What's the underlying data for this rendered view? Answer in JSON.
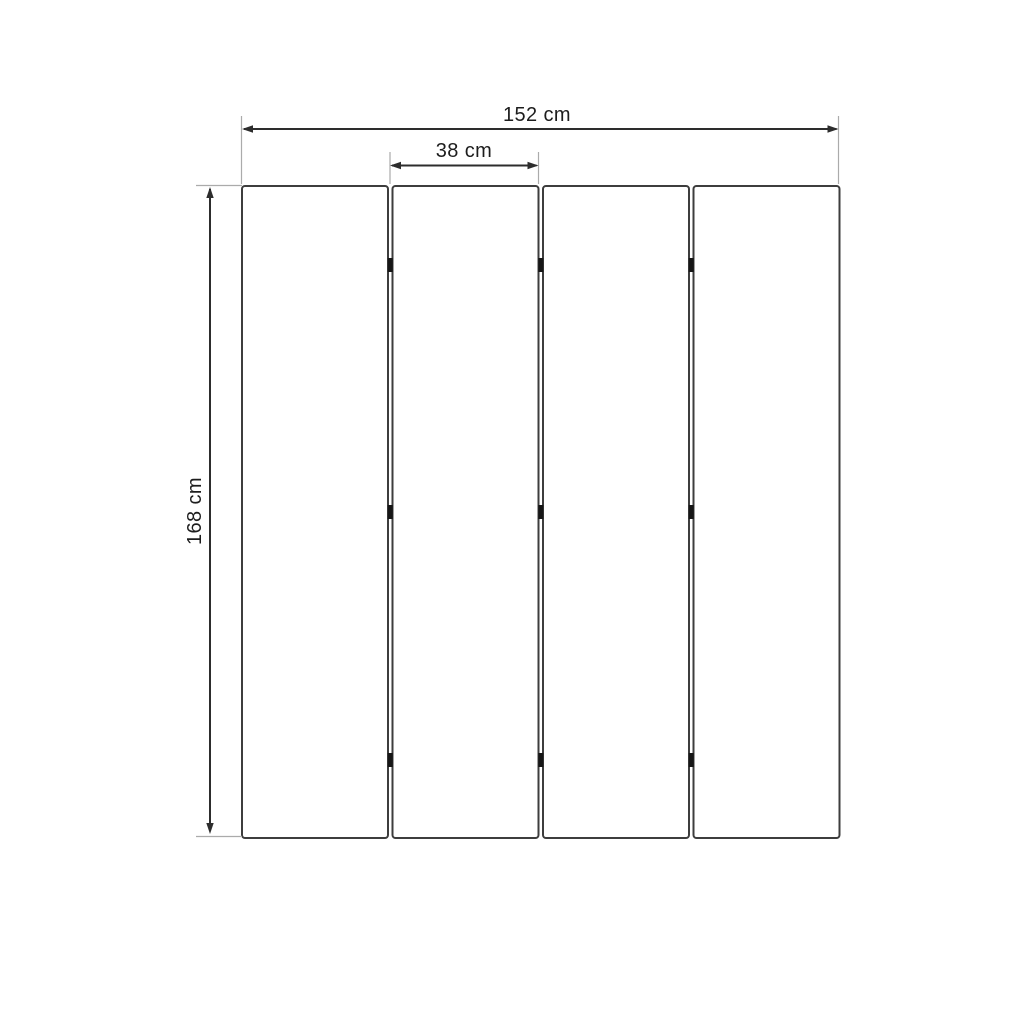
{
  "diagram": {
    "type": "technical-dimension-drawing",
    "panels": {
      "count": 4,
      "joints": 3,
      "hinges_per_joint": 3
    },
    "dimensions": {
      "total_width": {
        "label": "152 cm",
        "value": 152,
        "unit": "cm"
      },
      "panel_width": {
        "label": "38 cm",
        "value": 38,
        "unit": "cm"
      },
      "height": {
        "label": "168 cm",
        "value": 168,
        "unit": "cm"
      }
    },
    "colors": {
      "background": "#ffffff",
      "panel_fill": "#ffffff",
      "panel_stroke": "#3d3d3d",
      "dimension_line": "#2d2d2d",
      "extension_line": "#ababab",
      "hinge": "#161616",
      "text": "#1d1d1d"
    }
  }
}
